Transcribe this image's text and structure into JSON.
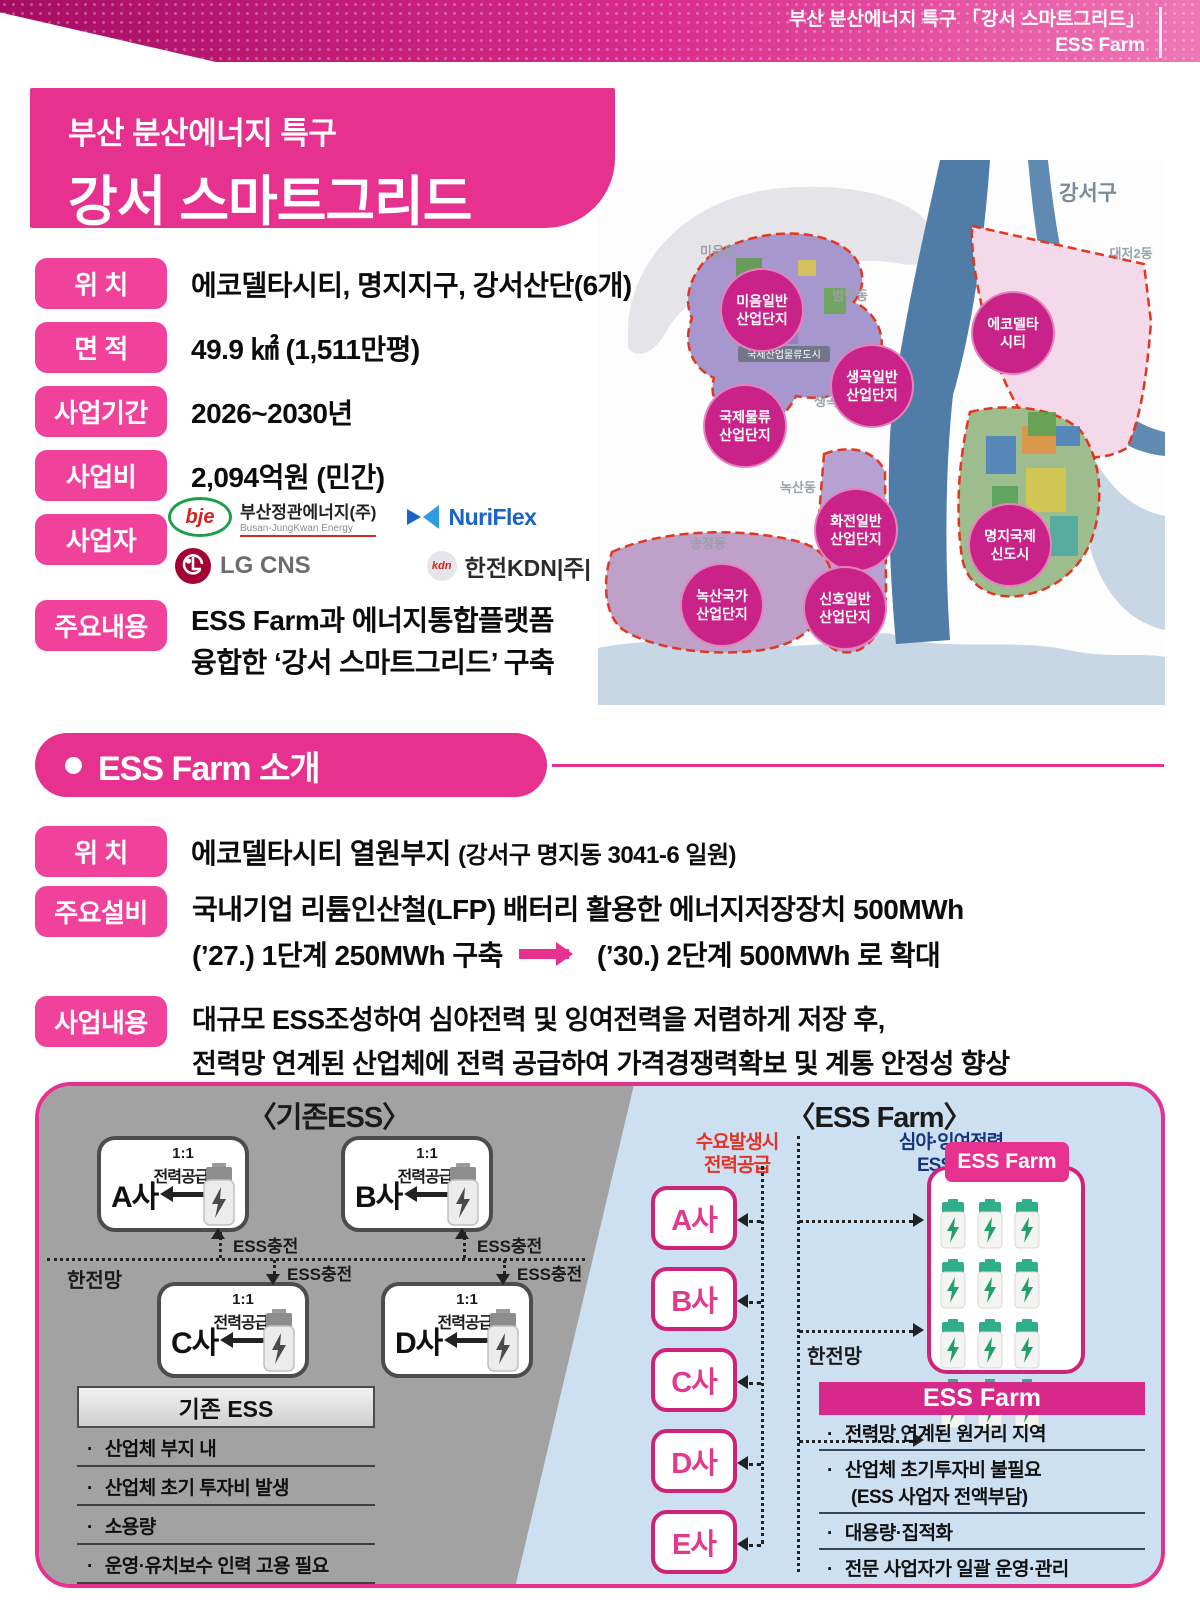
{
  "top_banner": {
    "line1": "부산 분산에너지 특구 「강서 스마트그리드」",
    "line2": "ESS Farm"
  },
  "title_box": {
    "line1": "부산 분산에너지 특구",
    "line2": "강서 스마트그리드"
  },
  "overview": {
    "rows": [
      {
        "label": "위 치",
        "value": "에코델타시티, 명지지구, 강서산단(6개)"
      },
      {
        "label": "면 적",
        "value": "49.9 ㎢ (1,511만평)"
      },
      {
        "label": "사업기간",
        "value": "2026~2030년"
      },
      {
        "label": "사업비",
        "value": "2,094억원 (민간)"
      }
    ],
    "operators_label": "사업자",
    "operators": {
      "bje_abbr": "bje",
      "bje_name": "부산정관에너지(주)",
      "bje_en": "Busan-JungKwan Energy",
      "nuriflex": "NuriFlex",
      "lg": "LG CNS",
      "kdn_abbr": "kdn",
      "kdn_name": "한전KDN|주|"
    },
    "summary_label": "주요내용",
    "summary_line1": "ESS Farm과 에너지통합플랫폼",
    "summary_line2": "융합한 ‘강서 스마트그리드’ 구축"
  },
  "map": {
    "district": "강서구",
    "city_badge": "국제산업물류도시",
    "towns": [
      "미음동",
      "범방동",
      "생곡동",
      "녹산동",
      "송정동",
      "대저2동"
    ],
    "zones": [
      {
        "l1": "미음일반",
        "l2": "산업단지"
      },
      {
        "l1": "생곡일반",
        "l2": "산업단지"
      },
      {
        "l1": "국제물류",
        "l2": "산업단지"
      },
      {
        "l1": "에코델타",
        "l2": "시티"
      },
      {
        "l1": "화전일반",
        "l2": "산업단지"
      },
      {
        "l1": "명지국제",
        "l2": "신도시"
      },
      {
        "l1": "녹산국가",
        "l2": "산업단지"
      },
      {
        "l1": "신호일반",
        "l2": "산업단지"
      }
    ]
  },
  "section2": {
    "title": "ESS Farm 소개",
    "location_label": "위 치",
    "location_value": "에코델타시티 열원부지",
    "location_paren": "(강서구 명지동 3041-6 일원)",
    "facility_label": "주요설비",
    "facility_line1": "국내기업 리튬인산철(LFP) 배터리 활용한 에너지저장장치 500MWh",
    "facility_phase1": "(’27.) 1단계 250MWh 구축",
    "facility_phase2": "(’30.) 2단계 500MWh 로 확대",
    "business_label": "사업내용",
    "business_line1": "대규모 ESS조성하여 심야전력 및 잉여전력을 저렴하게 저장 후,",
    "business_line2": "전력망 연계된 산업체에 전력 공급하여 가격경쟁력확보 및 계통 안정성 향상"
  },
  "diagram": {
    "left": {
      "title": "〈기존ESS〉",
      "supply_ratio": "1:1",
      "supply_text": "전력공급",
      "companies": [
        "A사",
        "B사",
        "C사",
        "D사"
      ],
      "charge_label": "ESS충전",
      "grid_label": "한전망",
      "table_title": "기존 ESS",
      "items": [
        "산업체 부지 내",
        "산업체 초기 투자비 발생",
        "소용량",
        "운영·유치보수 인력 고용 필요",
        "ESS-산업체 1:1 전력수요 대응"
      ]
    },
    "right": {
      "title": "〈ESS Farm〉",
      "demand_line1": "수요발생시",
      "demand_line2": "전력공급",
      "charge_line1": "심야·잉여전력",
      "charge_line2": "ESS충전",
      "companies": [
        "A사",
        "B사",
        "C사",
        "D사",
        "E사"
      ],
      "grid_label": "한전망",
      "farm_tab": "ESS Farm",
      "table_title": "ESS Farm",
      "items": [
        "전력망 연계된 원거리 지역",
        "산업체 초기투자비 불필요",
        "(ESS 사업자 전액부담)",
        "대용량·집적화",
        "전문 사업자가 일괄 운영·관리",
        "다수산업체 전력수요 동시관리"
      ]
    }
  }
}
